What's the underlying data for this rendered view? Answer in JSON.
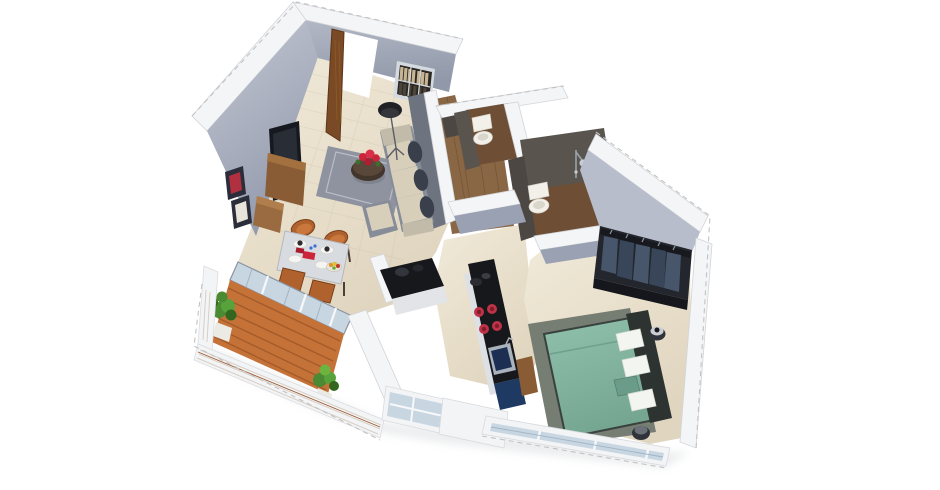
{
  "scene": {
    "title": "3D isometric cutaway floor plan of a one-bedroom apartment",
    "style": "dollhouse render, walls cut flat white with dashed outer edges, white background",
    "background": "#ffffff"
  },
  "rooms": [
    {
      "name": "living-room",
      "items": [
        "entrance-door-open",
        "wall-mounted-tv",
        "tv-console",
        "picture-frames",
        "bookshelf-niche",
        "floor-lamp",
        "sectional-sofa",
        "dark-round-back-pillows",
        "ottoman",
        "round-coffee-table",
        "red-flower-centerpiece",
        "gray-area-rug"
      ]
    },
    {
      "name": "dining-area",
      "items": [
        "dining-table",
        "orange-shell-chairs-x4",
        "white-plates",
        "red-food-items",
        "fruit-bowl"
      ]
    },
    {
      "name": "balcony",
      "items": [
        "sliding-glass-doors",
        "orange-wood-deck",
        "potted-plant-left",
        "potted-plant-right",
        "white-horizontal-railing"
      ]
    },
    {
      "name": "kitchen",
      "items": [
        "l-shaped-counter",
        "black-granite-countertop",
        "gas-hob-red-burners",
        "dark-sink",
        "navy-base-cabinets",
        "wood-tall-unit",
        "service-window-railing"
      ]
    },
    {
      "name": "bathroom-1",
      "items": [
        "white-toilet",
        "dark-tiled-walls",
        "wood-tile-floor"
      ]
    },
    {
      "name": "bathroom-2",
      "items": [
        "white-toilet",
        "chrome-shower",
        "dark-tiled-walls",
        "wood-tile-floor"
      ]
    },
    {
      "name": "passage",
      "items": [
        "wood-plank-flooring"
      ]
    },
    {
      "name": "bedroom",
      "items": [
        "double-bed-teal-duvet",
        "dark-headboard",
        "white-and-teal-pillows",
        "bedside-stool-x2",
        "dark-area-rug",
        "open-wardrobe-hanging-clothes",
        "window-railing"
      ]
    }
  ],
  "colors": {
    "bg": "#ffffff",
    "wallCut": "#f4f5f7",
    "wallEdge": "#d2d4d8",
    "dash": "#c2c2c2",
    "wallFaceLight": "#b7bdca",
    "wallFaceMid": "#9aa1b2",
    "wallFaceDark": "#6e7380",
    "wallFaceShadow": "#8b92a4",
    "floorCream": "#ebe3d1",
    "tileLine": "#c9bda6",
    "woodPassage": "#8a6744",
    "woodBath": "#6e4f36",
    "plankLine": "#5f432c",
    "deck": "#c47238",
    "deckLine": "#9c5526",
    "rug": "#8e939f",
    "rugEdge": "#b9bdc6",
    "sofaBase": "#878c99",
    "cushion": "#d8cfbb",
    "pillowDark": "#3a3f4c",
    "armrest": "#c2bbaa",
    "tableDark": "#42352c",
    "flowerRed": "#cc2438",
    "leafGreen": "#3e6f2f",
    "lampBlack": "#1f2127",
    "tvBlack": "#161920",
    "consoleWood": "#8a5c36",
    "frameDark": "#2b2e3a",
    "frameRed": "#b03040",
    "doorWood": "#7a4a26",
    "doorEdge": "#5d3518",
    "nicheDark": "#2b2823",
    "nicheFrame": "#d5dae0",
    "bookTan": "#c6b493",
    "bookDark": "#3a352c",
    "diningTop": "#d8dbdf",
    "chairOrange": "#b0622e",
    "chairDeep": "#8a4a20",
    "legDark": "#4a4038",
    "plateWhite": "#f4f4f1",
    "bathWall": "#5a544f",
    "bathWallDark": "#4c4742",
    "fixtureWhite": "#f2f0e9",
    "fixtureShade": "#d9d6cc",
    "chrome": "#c6cdd4",
    "bedTeal": "#84b5a1",
    "bedTealDark": "#6b9c89",
    "headboard": "#2c3331",
    "pillowWhite": "#f3f5f1",
    "bedRug": "#767d72",
    "stoolDark": "#30343a",
    "wardrobeDark": "#23262d",
    "clothA": "#47566b",
    "clothB": "#39465a",
    "railDark": "#17191e",
    "navy": "#1e3a63",
    "counterBlack": "#17181c",
    "burnerRed": "#bf3346",
    "burnerDark": "#801d2c",
    "sinkBlue": "#1c2f52",
    "glass": "#c8d6e2",
    "railWhite": "#f3f4f6",
    "railLine": "#d8cfc4",
    "railAccent": "#9c5b33",
    "plantGreen": "#4a8a33",
    "plantDark": "#33661f",
    "potWhite": "#eceae4",
    "shadow": "#9aa0a8"
  }
}
